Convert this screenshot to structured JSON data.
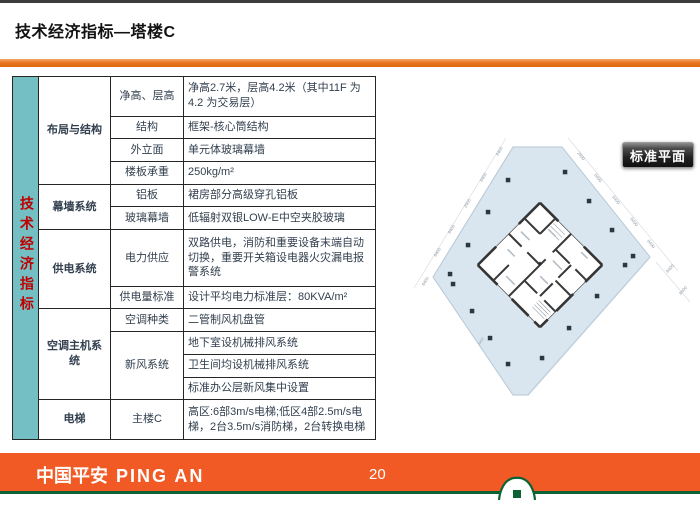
{
  "slide": {
    "title": "技术经济指标—塔楼C"
  },
  "sidebar": {
    "label": "技术经济指标"
  },
  "table": {
    "groups": [
      {
        "category": "布局与结构",
        "rows": [
          {
            "sub": "净高、层高",
            "value": "净高2.7米，层高4.2米（其中11F 为4.2 为交易层）"
          },
          {
            "sub": "结构",
            "value": "框架-核心筒结构"
          },
          {
            "sub": "外立面",
            "value": "单元体玻璃幕墙"
          },
          {
            "sub": "楼板承重",
            "value": "250kg/m²"
          }
        ]
      },
      {
        "category": "幕墙系统",
        "rows": [
          {
            "sub": "铝板",
            "value": "裙房部分高级穿孔铝板"
          },
          {
            "sub": "玻璃幕墙",
            "value": "低辐射双银LOW-E中空夹胶玻璃"
          }
        ]
      },
      {
        "category": "供电系统",
        "rows": [
          {
            "sub": "电力供应",
            "value": "双路供电，消防和重要设备末端自动切换，重要开关箱设电器火灾漏电报警系统"
          },
          {
            "sub": "供电量标准",
            "value": "设计平均电力标准层：80KVA/m²"
          }
        ]
      },
      {
        "category": "空调主机系统",
        "rows": [
          {
            "sub": "空调种类",
            "value": "二管制风机盘管"
          },
          {
            "sub": "新风系统",
            "values": [
              "地下室设机械排风系统",
              "卫生间均设机械排风系统",
              "标准办公层新风集中设置"
            ]
          }
        ]
      },
      {
        "category": "电梯",
        "rows": [
          {
            "sub": "主楼C",
            "value": "高区:6部3m/s电梯;低区4部2.5m/s电梯，2台3.5m/s消防梯，2台转换电梯"
          }
        ]
      }
    ]
  },
  "plan": {
    "button_label": "标准平面",
    "dims_nw": [
      "8400",
      "8400",
      "2500",
      "8400",
      "8400"
    ],
    "dims_ne": [
      "2500",
      "8400",
      "8400",
      "8400",
      "8400"
    ],
    "dims_right": [
      "8400",
      "8400"
    ],
    "dims_left": [
      "8400"
    ],
    "dims_field": [
      "8400"
    ]
  },
  "footer": {
    "brand_cn": "中国平安",
    "brand_en": "PING AN",
    "page_number": "20"
  },
  "colors": {
    "accent_orange": "#EA761E",
    "footer_orange": "#F15A24",
    "sidebar_teal": "#74BFC4",
    "sidebar_text_red": "#C00000",
    "brand_green": "#0D6233",
    "plan_fill": "#D9E6EF"
  }
}
